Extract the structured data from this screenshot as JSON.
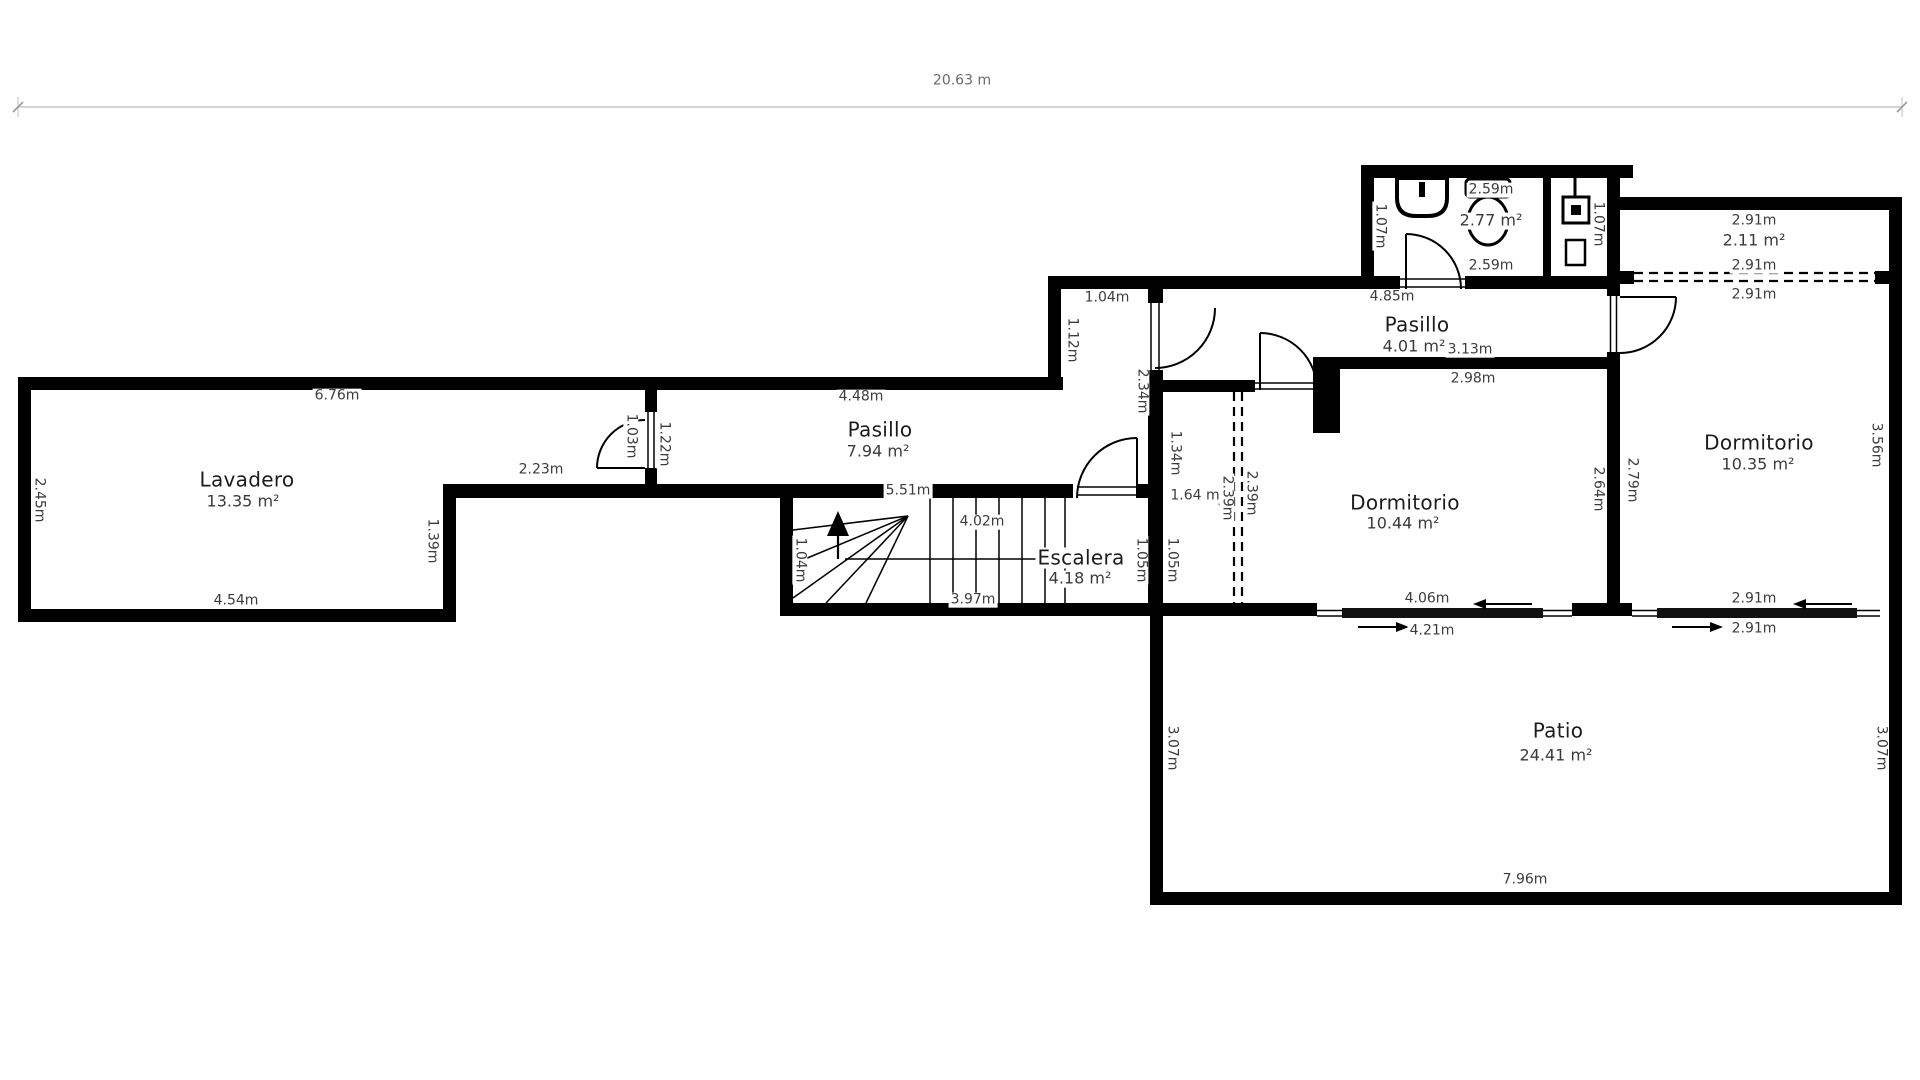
{
  "meta": {
    "drawing_type": "floor plan",
    "overall_dimension": "20.63 m"
  },
  "rooms": {
    "lavadero": {
      "name": "Lavadero",
      "area": "13.35 m²"
    },
    "pasillo_main": {
      "name": "Pasillo",
      "area": "7.94 m²"
    },
    "escalera": {
      "name": "Escalera",
      "area": "4.18 m²"
    },
    "pasillo_upper": {
      "name": "Pasillo",
      "area": "4.01 m²"
    },
    "bano": {
      "area": "2.77 m²"
    },
    "cuarto_sup": {
      "area": "2.11 m²"
    },
    "dormitorio_1": {
      "name": "Dormitorio",
      "area": "10.44 m²"
    },
    "dormitorio_2": {
      "name": "Dormitorio",
      "area": "10.35 m²"
    },
    "patio": {
      "name": "Patio",
      "area": "24.41 m²"
    }
  },
  "dims": {
    "total": "20.63 m",
    "lav_top": "6.76m",
    "lav_left": "2.45m",
    "lav_bottom": "4.54m",
    "lav_right": "1.39m",
    "passage": "2.23m",
    "door_lav": "1.03m",
    "pas1_left": "1.22m",
    "pas1_top": "4.48m",
    "pas1_bottom": "5.51m",
    "esc_top": "4.02m",
    "esc_bottom": "3.97m",
    "esc_left": "1.04m",
    "corr_w": "1.04m",
    "corr_h": "1.12m",
    "corr_wall": "2.34m",
    "mid_134": "1.34m",
    "mid_105a": "1.05m",
    "mid_105b": "1.05m",
    "mid_164": "1.64 m",
    "open_239a": "2.39m",
    "open_239b": "2.39m",
    "pas2_w": "4.85m",
    "pas2_313": "3.13m",
    "dorm1_top": "2.98m",
    "bano_top": "2.59m",
    "bano_bottom": "2.59m",
    "bano_left": "1.07m",
    "bano_right": "1.07m",
    "dorm1_r1": "2.64m",
    "dorm1_r2": "2.79m",
    "slide1_a": "4.06m",
    "slide1_b": "4.21m",
    "strip_top": "2.91m",
    "dash_a": "2.91m",
    "dash_b": "2.91m",
    "dorm2_right": "3.56m",
    "slide2_a": "2.91m",
    "slide2_b": "2.91m",
    "patio_left": "3.07m",
    "patio_right": "3.07m",
    "patio_bottom": "7.96m"
  },
  "colors": {
    "wall": "#000000",
    "text": "#3c3c3c",
    "dim_line": "#d6d6d6",
    "dim_tick": "#9a9a9a"
  }
}
